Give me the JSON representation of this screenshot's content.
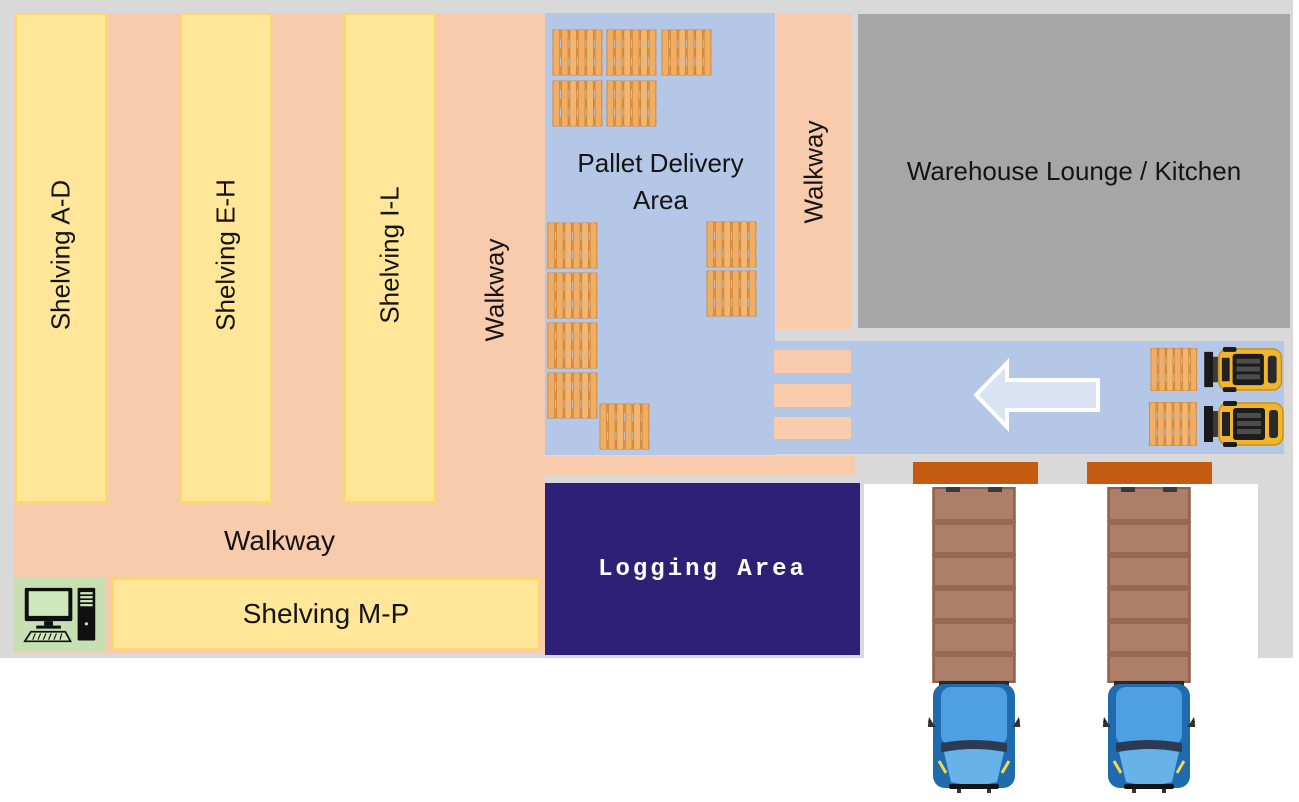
{
  "page": {
    "type": "warehouse-floor-plan"
  },
  "areas": {
    "shelving_ad": {
      "label": "Shelving A-D",
      "fill": "#ffe699"
    },
    "shelving_eh": {
      "label": "Shelving E-H",
      "fill": "#ffe699"
    },
    "shelving_il": {
      "label": "Shelving I-L",
      "fill": "#ffe699"
    },
    "shelving_mp": {
      "label": "Shelving M-P",
      "fill": "#ffe699"
    },
    "walkway_left": {
      "label": "Walkway",
      "fill": "#f8cbad"
    },
    "walkway_right": {
      "label": "Walkway",
      "fill": "#f8cbad"
    },
    "walkway_bottom": {
      "label": "Walkway",
      "fill": "#f8cbad"
    },
    "pallet_delivery": {
      "label": "Pallet Delivery Area",
      "fill": "#b4c7e7"
    },
    "lounge": {
      "label": "Warehouse Lounge / Kitchen",
      "fill": "#a6a6a6"
    },
    "logging": {
      "label": "Logging Area",
      "fill": "#2e2076",
      "text_color": "#ffffff"
    }
  },
  "objects": {
    "delivery_area_pallets": 12,
    "forklifts_with_pallets": 2,
    "loading_docks": 2,
    "trucks": 2,
    "crosswalk_stripes": 3,
    "computer_workstations": 1,
    "flow_arrow_direction": "left"
  },
  "colors": {
    "canvas_gray": "#d9d9d9",
    "lounge_gray": "#a6a6a6",
    "shelving_yellow": "#ffe699",
    "shelving_border": "#ffd966",
    "walkway_peach": "#f8cbad",
    "floor_blue": "#b4c7e7",
    "logging_navy": "#2e2076",
    "dock_orange": "#c55a11",
    "arrow_fill": "#dae3f3",
    "workstation_green": "#c6e0b4",
    "pallet_wood": "#f1ae63",
    "trailer_brown": "#ad7f6b",
    "truck_blue": "#4f9fe3",
    "forklift_yellow": "#f2b62d"
  }
}
